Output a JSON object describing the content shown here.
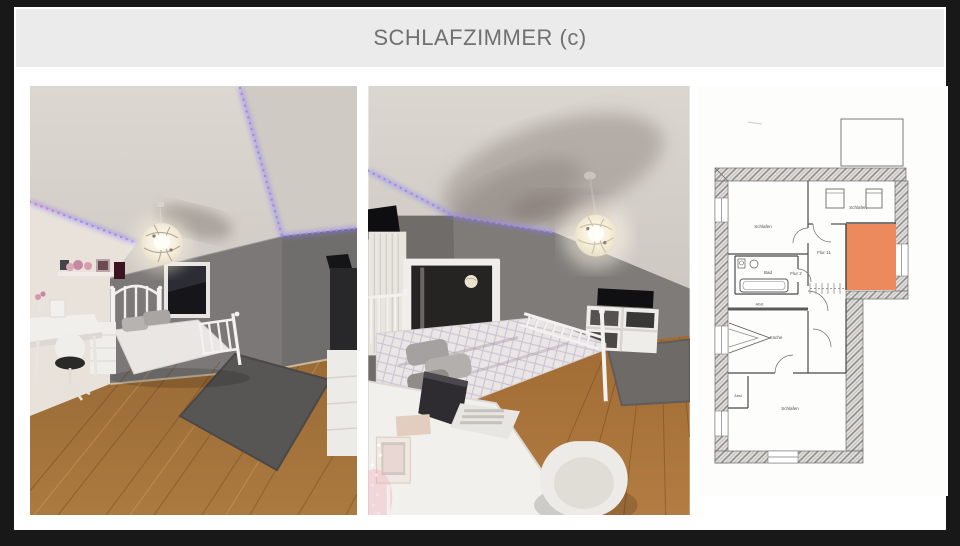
{
  "page": {
    "frame_color": "#181818",
    "content_bg": "#ffffff"
  },
  "header": {
    "title": "SCHLAFZIMMER (c)",
    "bg_color": "#ebebeb",
    "text_color": "#707070"
  },
  "gallery": {
    "photo_left_name": "bedroom-photo-desk-view",
    "photo_right_name": "bedroom-photo-bed-mirror-view"
  },
  "floorplan": {
    "highlight_color": "#ec8a5e",
    "labels": {
      "schlafen_left": "Schlafen",
      "schlafen_top": "Schlafen",
      "schlafen_bottom": "Schlafen",
      "flur_upper": "Flur 11",
      "flur_lower": "Flur 2",
      "bad": "Bad",
      "abst_upper": "Abst.",
      "kueche": "Küche",
      "abst_lower": "Abst"
    }
  }
}
